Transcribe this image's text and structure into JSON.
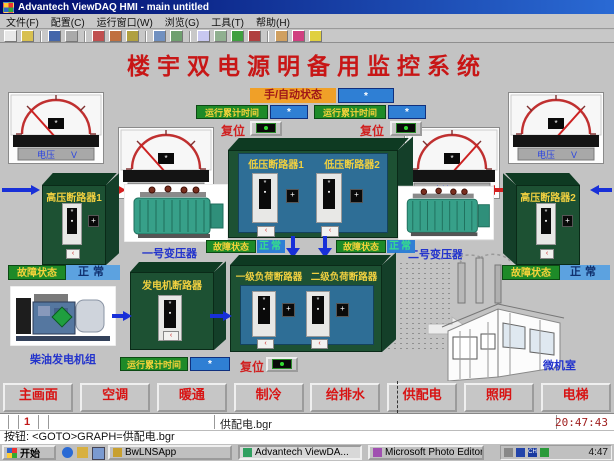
{
  "window": {
    "title": "Advantech ViewDAQ HMI - main untitled",
    "menus": [
      "文件(F)",
      "配置(C)",
      "运行窗口(W)",
      "浏览(G)",
      "工具(T)",
      "帮助(H)"
    ]
  },
  "toolbar": {
    "icons": [
      "new-icon",
      "open-icon",
      "save-icon",
      "print-icon",
      "cut-icon",
      "copy-icon",
      "paste-icon",
      "undo-icon",
      "redo-icon",
      "zoom-icon",
      "grid-icon",
      "run-icon",
      "stop-icon",
      "chart-icon",
      "alarm-icon",
      "help-icon"
    ]
  },
  "screen": {
    "main_title": "楼宇双电源明备用监控系统",
    "mode": {
      "label": "手/自动状态",
      "value": "*"
    },
    "runtime_left": {
      "label": "运行累计时间",
      "value": "*"
    },
    "runtime_right": {
      "label": "运行累计时间",
      "value": "*"
    },
    "runtime_gen": {
      "label": "运行累计时间",
      "value": "*"
    },
    "reset_left": "复位",
    "reset_right": "复位",
    "reset_gen": "复位",
    "meters": [
      {
        "label": "电压",
        "unit": "V"
      },
      {
        "label": "电流",
        "unit": "A"
      },
      {
        "label": "电流",
        "unit": "A"
      },
      {
        "label": "电压",
        "unit": "V"
      }
    ],
    "cabinets": {
      "hv1": "高压断路器1",
      "hv2": "高压断路器2",
      "lv1": "低压断路器1",
      "lv2": "低压断路器2",
      "gen": "发电机断路器",
      "load1": "一级负荷断路器",
      "load2": "二级负荷断路器"
    },
    "devices": {
      "t1": "一号变压器",
      "t2": "二号变压器",
      "genset": "柴油发电机组",
      "room": "微机室"
    },
    "status_left": {
      "label": "故障状态",
      "value": "正常"
    },
    "status_right": {
      "label": "故障状态",
      "value": "正常"
    },
    "status_mid_left": {
      "label": "故障状态",
      "value": "正常"
    },
    "status_mid_right": {
      "label": "故障状态",
      "value": "正常"
    }
  },
  "nav": {
    "buttons": [
      "主画面",
      "空调",
      "暖通",
      "制冷",
      "给排水",
      "供配电",
      "照明",
      "电梯"
    ]
  },
  "statusbar": {
    "page": "1",
    "file": "供配电.bgr",
    "time": "20:47:43"
  },
  "command_line": "按钮: <GOTO>GRAPH=供配电.bgr",
  "taskbar": {
    "start_label": "开始",
    "tasks": [
      "BwLNSApp",
      "Advantech ViewDA...",
      "Microsoft Photo Editor"
    ],
    "tray_time": "4:47"
  }
}
